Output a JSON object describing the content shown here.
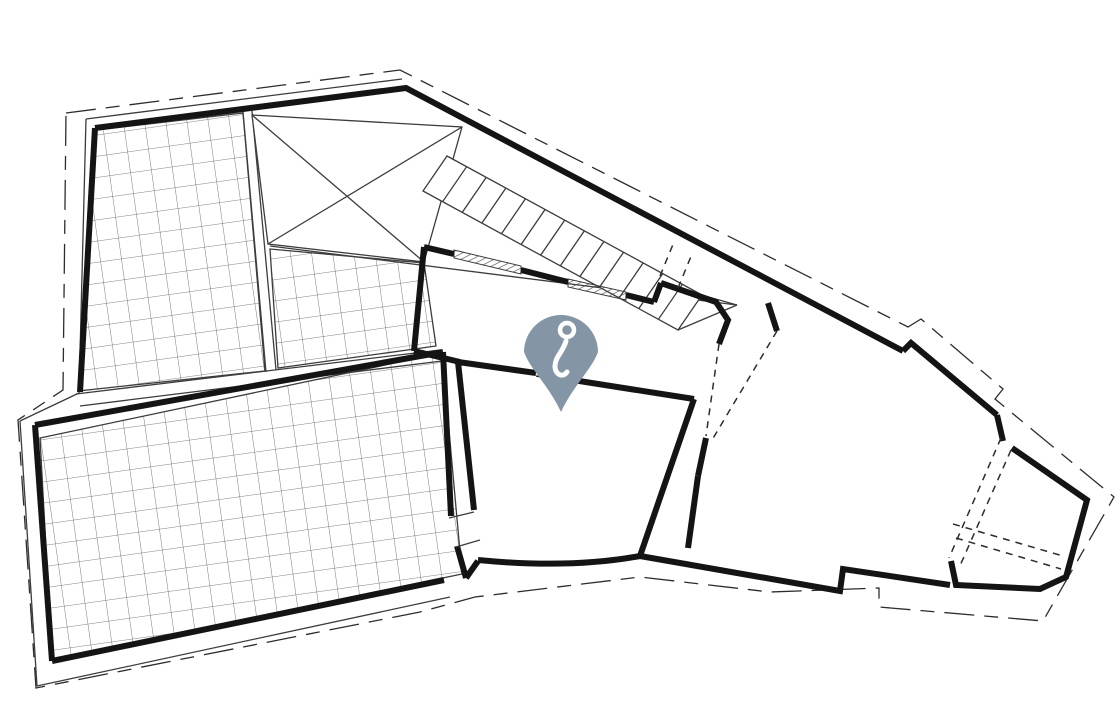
{
  "meta": {
    "type": "architectural-floor-plan",
    "canvas": {
      "width": 1120,
      "height": 720
    },
    "background": "#ffffff"
  },
  "colors": {
    "wall": "#141414",
    "thin": "#3c3c3c",
    "dashed": "#2c2c2c",
    "grid": "#595959",
    "glazing": "#444444",
    "pin": "#8495a6",
    "pin_glyph": "#ffffff"
  },
  "pin": {
    "icon": "hook-icon",
    "cx": 561,
    "cy": 345,
    "r": 37,
    "tip_x": 561,
    "tip_y": 412,
    "body_path": "M561,412 C549,386 530,369 524,352 A37,37 0 1 1 598,352 C592,369 573,386 561,412 Z",
    "ring": {
      "cx": 567,
      "cy": 330,
      "r": 7,
      "stroke_width": 4.5
    },
    "tail_path": "M566,341 C563,352 555,357 555,366 C555,375 563,378 567,372",
    "tail_stroke_width": 5
  },
  "plan": {
    "stroke_widths": {
      "wall": 6,
      "thin": 1.3,
      "dashed": 1.5,
      "grid": 0.8
    },
    "boundary_dash": "30 10 14 10",
    "opening_dash": "7 6",
    "dashed_boundary": [
      [
        66,
        113
      ],
      [
        400,
        70
      ],
      [
        908,
        327
      ],
      [
        921,
        319
      ],
      [
        1003,
        389
      ],
      [
        995,
        399
      ],
      [
        1114,
        497
      ],
      [
        1043,
        621
      ],
      [
        879,
        607
      ],
      [
        879,
        588
      ],
      [
        770,
        592
      ],
      [
        640,
        577
      ],
      [
        475,
        597
      ],
      [
        420,
        612
      ],
      [
        36,
        688
      ],
      [
        18,
        420
      ],
      [
        63,
        390
      ]
    ],
    "thin_lines": [
      [
        [
          86,
          119
        ],
        [
          402,
          79
        ]
      ],
      [
        [
          86,
          119
        ],
        [
          79,
          393
        ]
      ],
      [
        [
          79,
          393
        ],
        [
          20,
          421
        ]
      ],
      [
        [
          20,
          421
        ],
        [
          37,
          686
        ]
      ],
      [
        [
          37,
          686
        ],
        [
          450,
          597
        ]
      ],
      [
        [
          678,
          330
        ],
        [
          737,
          305
        ]
      ],
      [
        [
          270,
          246
        ],
        [
          737,
          305
        ]
      ],
      [
        [
          662,
          284
        ],
        [
          737,
          305
        ]
      ],
      [
        [
          243,
          112
        ],
        [
          266,
          372
        ]
      ],
      [
        [
          252,
          111
        ],
        [
          276,
          370
        ]
      ],
      [
        [
          76,
          394
        ],
        [
          440,
          350
        ]
      ],
      [
        [
          80,
          406
        ],
        [
          442,
          361
        ]
      ]
    ],
    "terraces": [
      [
        [
          97,
          130
        ],
        [
          243,
          113
        ],
        [
          265,
          371
        ],
        [
          78,
          391
        ]
      ],
      [
        [
          270,
          249
        ],
        [
          424,
          263
        ],
        [
          436,
          346
        ],
        [
          278,
          368
        ]
      ],
      [
        [
          40,
          438
        ],
        [
          442,
          353
        ],
        [
          462,
          574
        ],
        [
          52,
          659
        ]
      ]
    ],
    "void_quad": {
      "outline": [
        [
          252,
          115
        ],
        [
          462,
          127
        ],
        [
          424,
          262
        ],
        [
          268,
          244
        ]
      ],
      "diagonals": [
        [
          [
            252,
            115
          ],
          [
            424,
            262
          ]
        ],
        [
          [
            462,
            127
          ],
          [
            268,
            244
          ]
        ]
      ]
    },
    "stairs": {
      "edge_top": [
        [
          447,
          156
        ],
        [
          702,
          295
        ]
      ],
      "edge_bottom": [
        [
          423,
          191
        ],
        [
          678,
          330
        ]
      ],
      "tread_count": 13
    },
    "walls": [
      [
        [
          95,
          128
        ],
        [
          406,
          88
        ],
        [
          903,
          351
        ]
      ],
      [
        [
          903,
          351
        ],
        [
          911,
          343
        ],
        [
          997,
          415
        ]
      ],
      [
        [
          997,
          415
        ],
        [
          1003,
          441
        ]
      ],
      [
        [
          1012,
          448
        ],
        [
          1087,
          500
        ],
        [
          1066,
          577
        ],
        [
          1040,
          589
        ],
        [
          956,
          585
        ],
        [
          951,
          561
        ]
      ],
      [
        [
          80,
          392
        ],
        [
          95,
          128
        ]
      ],
      [
        [
          35,
          425
        ],
        [
          443,
          352
        ]
      ],
      [
        [
          35,
          425
        ],
        [
          52,
          661
        ]
      ],
      [
        [
          52,
          661
        ],
        [
          444,
          580
        ]
      ],
      [
        [
          443,
          352
        ],
        [
          451,
          516
        ]
      ],
      [
        [
          457,
          546
        ],
        [
          466,
          578
        ]
      ],
      [
        [
          466,
          578
        ],
        [
          478,
          561
        ]
      ],
      [
        [
          458,
          362
        ],
        [
          474,
          510
        ]
      ],
      [
        [
          640,
          556
        ],
        [
          840,
          591
        ],
        [
          843,
          569
        ],
        [
          950,
          585
        ]
      ],
      [
        [
          640,
          556
        ],
        [
          694,
          399
        ]
      ],
      [
        [
          458,
          362
        ],
        [
          536,
          373
        ]
      ],
      [
        [
          560,
          378
        ],
        [
          694,
          399
        ]
      ],
      [
        [
          424,
          247
        ],
        [
          414,
          351
        ]
      ],
      [
        [
          414,
          351
        ],
        [
          460,
          362
        ]
      ],
      [
        [
          424,
          247
        ],
        [
          454,
          254
        ]
      ],
      [
        [
          521,
          270
        ],
        [
          568,
          282
        ]
      ],
      [
        [
          626,
          295
        ],
        [
          654,
          302
        ]
      ],
      [
        [
          654,
          302
        ],
        [
          661,
          283
        ]
      ],
      [
        [
          661,
          283
        ],
        [
          716,
          302
        ],
        [
          728,
          320
        ],
        [
          719,
          344
        ]
      ],
      [
        [
          768,
          303
        ],
        [
          777,
          331
        ]
      ],
      [
        [
          706,
          438
        ],
        [
          698,
          476
        ]
      ],
      [
        [
          698,
          476
        ],
        [
          688,
          548
        ]
      ]
    ],
    "curve_walls": [
      "M478,560 Q570,569 640,556"
    ],
    "dashed_lines": [
      [
        [
          719,
          344
        ],
        [
          706,
          436
        ]
      ],
      [
        [
          777,
          331
        ],
        [
          712,
          440
        ]
      ],
      [
        [
          660,
          276
        ],
        [
          674,
          242
        ]
      ],
      [
        [
          678,
          288
        ],
        [
          692,
          254
        ]
      ],
      [
        [
          1001,
          438
        ],
        [
          949,
          558
        ]
      ],
      [
        [
          1011,
          450
        ],
        [
          959,
          568
        ]
      ],
      [
        [
          953,
          524
        ],
        [
          1063,
          556
        ]
      ],
      [
        [
          956,
          538
        ],
        [
          1061,
          569
        ]
      ],
      [
        [
          536,
          376
        ],
        [
          560,
          381
        ]
      ]
    ],
    "windows": [
      [
        [
          454,
          250
        ],
        [
          521,
          266
        ],
        [
          521,
          274
        ],
        [
          454,
          258
        ]
      ],
      [
        [
          568,
          279
        ],
        [
          626,
          292
        ],
        [
          626,
          300
        ],
        [
          568,
          287
        ]
      ]
    ],
    "door_jambs": [
      [
        [
          449,
          518
        ],
        [
          474,
          512
        ]
      ],
      [
        [
          456,
          547
        ],
        [
          480,
          540
        ]
      ]
    ]
  }
}
